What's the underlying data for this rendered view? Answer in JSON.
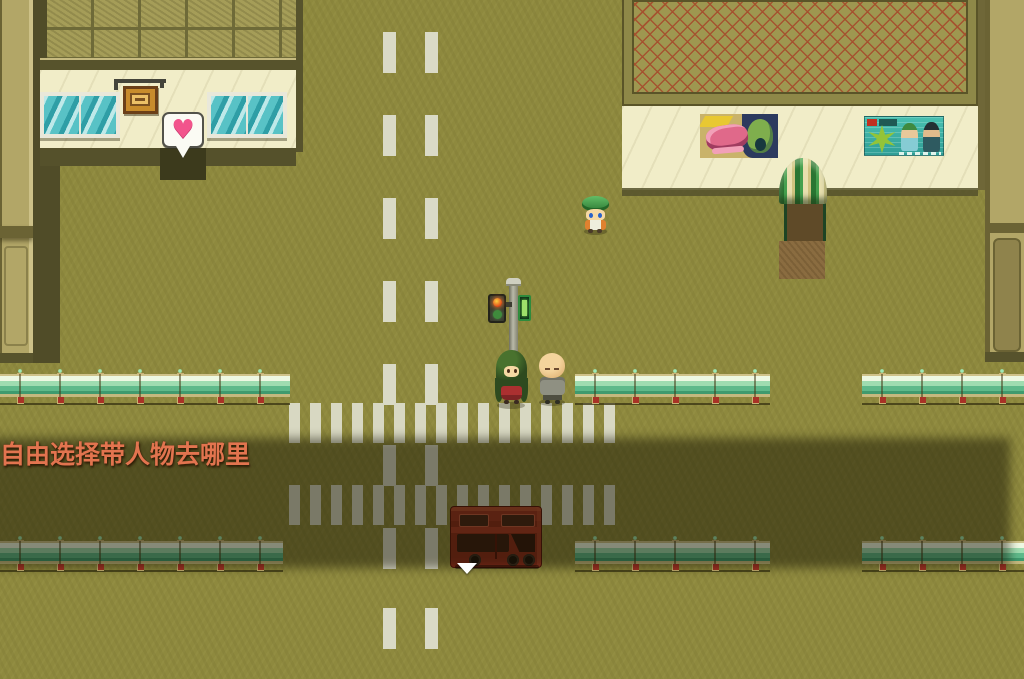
{
  "game": {
    "instruction": {
      "text": "自由选择带人物去哪里",
      "color": "#e2744f"
    },
    "bubble": {
      "heart_glyph": "♥",
      "heart_color": "#f2548c"
    },
    "cursor": {
      "shape": "down-triangle",
      "color": "#ffffff"
    },
    "palette": {
      "ground": "#8e893e",
      "road_dash": "#dadac6",
      "zebra_stripe": "#d8d8c2",
      "dim_overlay": "rgba(17,14,1,0.47)",
      "boundary_wall": "#b2a667",
      "building_wall": "#f1edc8",
      "roof_left": "#a59d58",
      "roof_right_base": "#9e9750",
      "roof_right_lattice": "#a5512f",
      "window_teal": "#4ab4bc",
      "sign_orange": "#c88c2c",
      "awning_green": "#2f8038",
      "awning_cream": "#e8dfae",
      "dirt_path": "#8a6c40",
      "fence_rail": "#9fdcb0",
      "fence_post": "#c9b273",
      "bus_red": "#9c3322",
      "traffic_red_light": "#e04818",
      "traffic_green_light": "#4fae4a"
    },
    "map": {
      "dash_columns": [
        383,
        425
      ],
      "dash_spans": [
        {
          "y": 32,
          "h": 373
        },
        {
          "y": 445,
          "h": 124
        },
        {
          "y": 608,
          "h": 41
        }
      ],
      "zebra": {
        "x": 289,
        "w": 330,
        "h": 40,
        "rows": [
          403,
          485
        ]
      },
      "fence_rows": [
        {
          "y": 368,
          "segments": [
            [
              0,
              290
            ],
            [
              575,
              195
            ],
            [
              862,
              162
            ]
          ]
        },
        {
          "y": 535,
          "segments": [
            [
              0,
              283
            ],
            [
              575,
              195
            ],
            [
              862,
              162
            ]
          ]
        }
      ]
    },
    "entities": {
      "characters": [
        {
          "id": "green-cap-kid",
          "x": 582,
          "y": 194
        },
        {
          "id": "green-hair-girl",
          "x": 495,
          "y": 348
        },
        {
          "id": "bald-man",
          "x": 537,
          "y": 353
        }
      ],
      "props": [
        {
          "id": "red-bus",
          "x": 450,
          "y": 506
        }
      ]
    }
  }
}
